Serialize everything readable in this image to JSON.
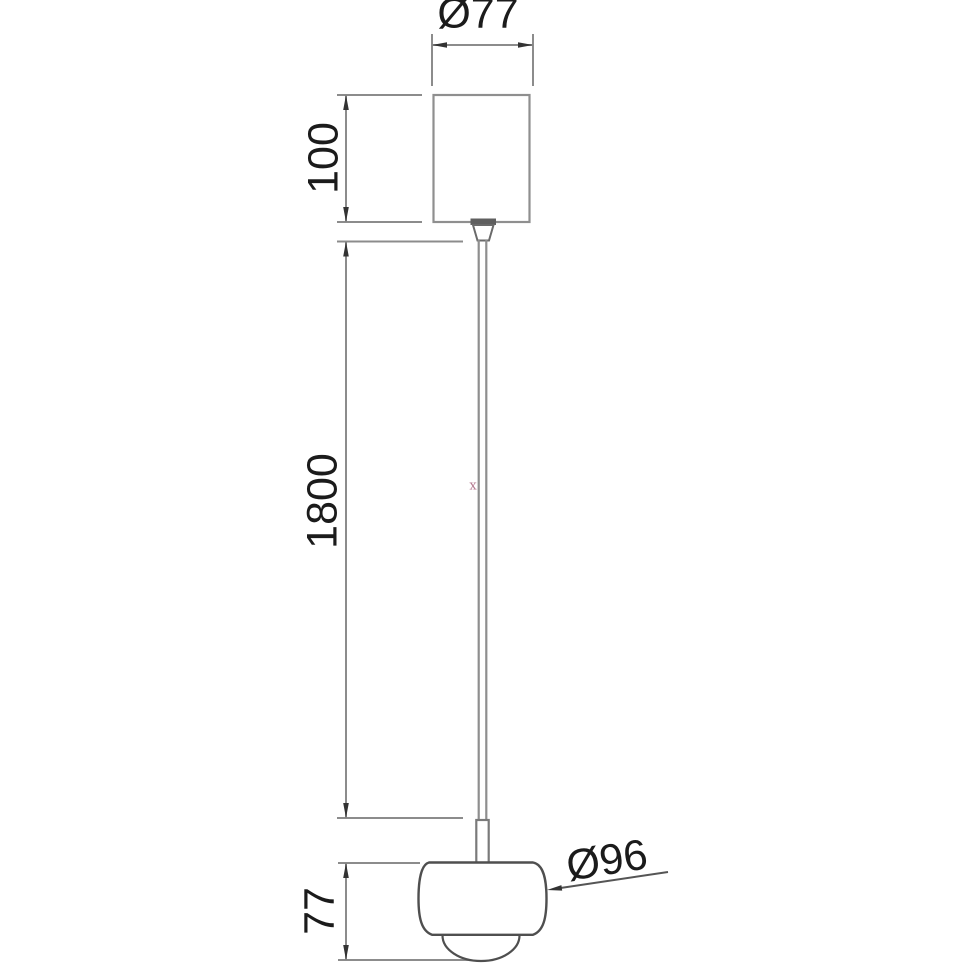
{
  "page": {
    "background": "#ffffff",
    "kind": "technical dimension drawing of a pendant lamp"
  },
  "drawing": {
    "dimensions": {
      "canopy_diameter": {
        "label": "Ø77",
        "orientation": "horizontal",
        "applies_to": "ceiling canopy width"
      },
      "canopy_height": {
        "label": "100",
        "orientation": "vertical",
        "applies_to": "ceiling canopy height"
      },
      "cable_length": {
        "label": "1800",
        "orientation": "vertical",
        "applies_to": "suspension cable length"
      },
      "head_height": {
        "label": "77",
        "orientation": "vertical",
        "applies_to": "lamp head height"
      },
      "head_diameter": {
        "label": "Ø96",
        "orientation": "leader",
        "applies_to": "lamp head diameter"
      }
    },
    "marker": {
      "label": "x",
      "color": "#b4798f"
    },
    "colors": {
      "dimension_line": "#8c8c8c",
      "arrowhead": "#333333",
      "canopy_outline": "#8f8f8f",
      "object_outline": "#4f4f4f",
      "cable_line": "#8e8e8e",
      "text": "#1b1b1b"
    }
  }
}
